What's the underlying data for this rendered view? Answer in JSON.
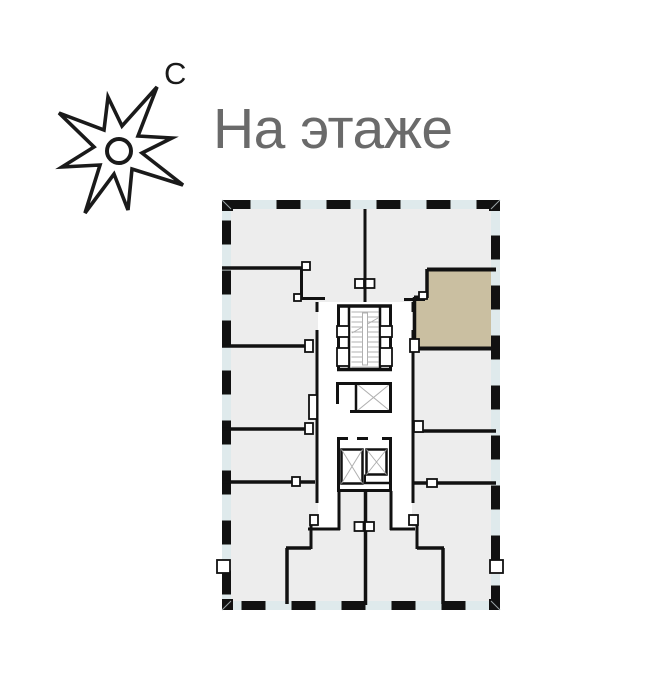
{
  "header": {
    "title": "На этаже"
  },
  "compass": {
    "north_label": "С"
  },
  "colors": {
    "wall": "#111111",
    "room": "#ededed",
    "corridor": "#ffffff",
    "highlight": "#cabfa1",
    "band": "#dfeaec",
    "detail": "#b0b0b0",
    "title": "#6a6a6a",
    "background": "#ffffff"
  }
}
